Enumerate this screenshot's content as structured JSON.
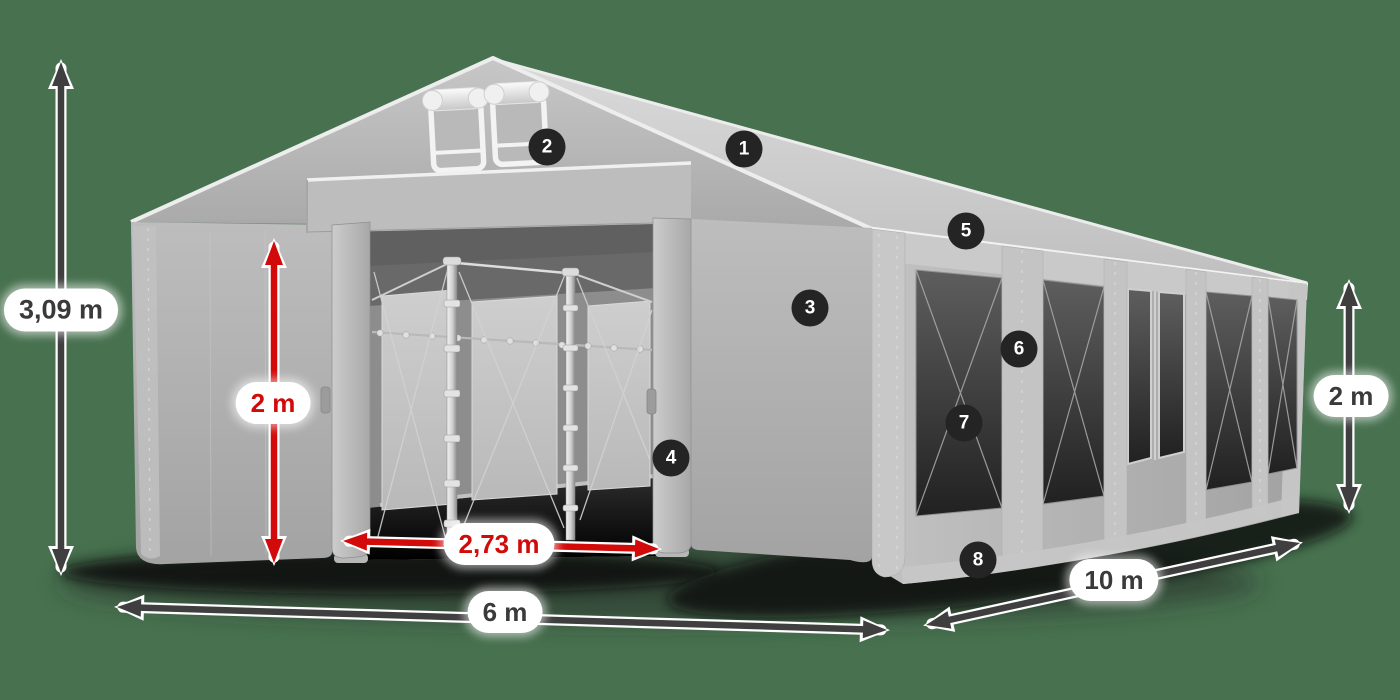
{
  "colors": {
    "background": "#47714F",
    "dimension_red": "#D20A0A",
    "dimension_dark": "#3F3F3F",
    "label_bg": "#FFFFFF",
    "label_text_dark": "#3A3A3A",
    "badge_bg": "#242424",
    "badge_text": "#FFFFFF",
    "tent_roof": "#CDCDCD",
    "tent_wall": "#B5B5B5",
    "window_dark": "#2E2E2E"
  },
  "dimensions": {
    "total_height": "3,09 m",
    "entrance_height": "2 m",
    "entrance_width": "2,73 m",
    "front_width": "6 m",
    "side_length": "10 m",
    "side_wall_height": "2 m"
  },
  "callouts": [
    "1",
    "2",
    "3",
    "4",
    "5",
    "6",
    "7",
    "8"
  ]
}
